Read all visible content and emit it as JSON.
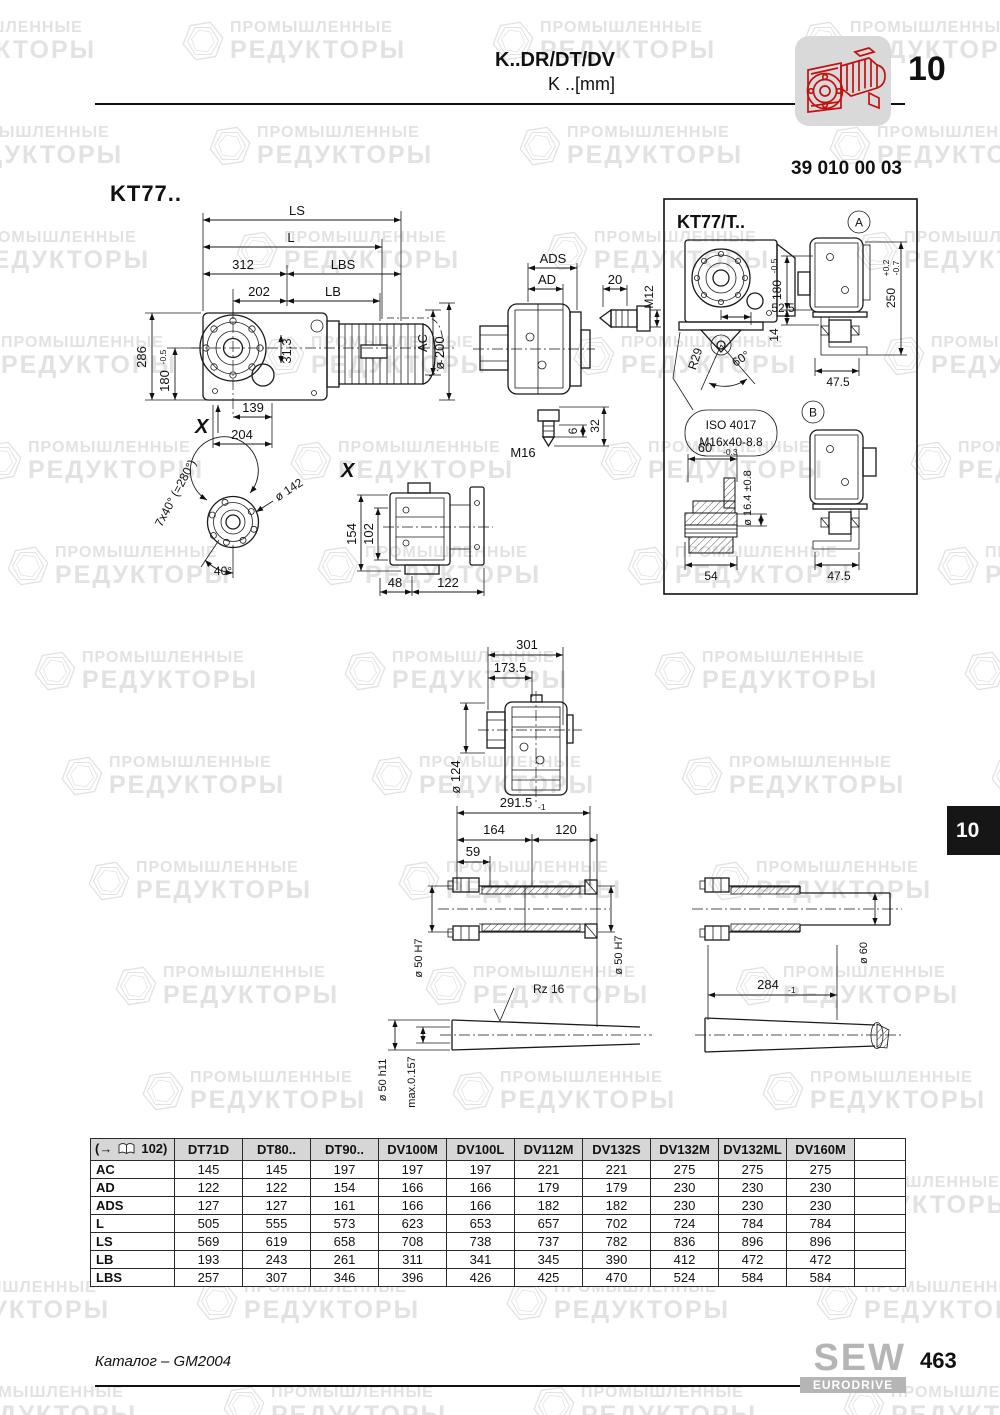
{
  "header": {
    "title_line1": "K..DR/DT/DV",
    "title_line2": "K ..[mm]",
    "chapter_number": "10",
    "drawing_number": "39 010 00 03",
    "accent_red": "#cc1111"
  },
  "watermark": {
    "line1": "ПРОМЫШЛЕННЫЕ",
    "line2": "РЕДУКТОРЫ"
  },
  "drawings": {
    "main": {
      "label": "KT77..",
      "ls": "LS",
      "l": "L",
      "n312": "312",
      "lbs": "LBS",
      "n202": "202",
      "lb": "LB",
      "n286": "286",
      "n180": "180",
      "tol180": "-0.5",
      "n313": "31.3",
      "ac": "AC",
      "dia200": "ø 200",
      "n139": "139",
      "n204": "204",
      "x": "X"
    },
    "adapter": {
      "ads": "ADS",
      "ad": "AD",
      "n20": "20",
      "m12": "M12",
      "n6": "6",
      "n32": "32",
      "m16": "M16"
    },
    "kt77t": {
      "label": "KT77/T..",
      "view_a": "A",
      "view_b": "B",
      "n525": "52.5",
      "n180": "180",
      "tol180": "-0.5",
      "n250": "250",
      "tol250u": "+0.2",
      "tol250d": "-0.7",
      "n14": "14",
      "n475a": "47.5",
      "r29": "R29",
      "a60": "60°",
      "iso1": "ISO 4017",
      "iso2": "M16x40-8.8",
      "n60": "60",
      "tol60": "-0.3",
      "dia164": "ø 16.4 ±0.8",
      "n54": "54",
      "n475b": "47.5"
    },
    "detailx": {
      "x": "X",
      "seven40": "7x40° (=280°)",
      "dia142": "ø 142",
      "a40": "40°",
      "n154": "154",
      "n102": "102",
      "n48": "48",
      "n122": "122"
    },
    "mid": {
      "n301": "301",
      "n1735": "173.5",
      "dia124": "ø 124"
    },
    "shafts": {
      "n2915": "291.5",
      "tol2915": "-1",
      "n164": "164",
      "n120": "120",
      "n59": "59",
      "dia50l": "ø 50 H7",
      "dia50r": "ø 50 H7",
      "dia60": "ø 60",
      "n284": "284",
      "tol284": "-1",
      "rz": "Rz 16",
      "dia50c": "ø 50 h11",
      "maxrun": "max.0.157"
    }
  },
  "side_tab": {
    "label": "10"
  },
  "table": {
    "ref_label": "(→",
    "ref_page": "102)",
    "columns": [
      "DT71D",
      "DT80..",
      "DT90..",
      "DV100M",
      "DV100L",
      "DV112M",
      "DV132S",
      "DV132M",
      "DV132ML",
      "DV160M"
    ],
    "rows": [
      {
        "label": "AC",
        "values": [
          "145",
          "145",
          "197",
          "197",
          "197",
          "221",
          "221",
          "275",
          "275",
          "275"
        ]
      },
      {
        "label": "AD",
        "values": [
          "122",
          "122",
          "154",
          "166",
          "166",
          "179",
          "179",
          "230",
          "230",
          "230"
        ]
      },
      {
        "label": "ADS",
        "values": [
          "127",
          "127",
          "161",
          "166",
          "166",
          "182",
          "182",
          "230",
          "230",
          "230"
        ]
      },
      {
        "label": "L",
        "values": [
          "505",
          "555",
          "573",
          "623",
          "653",
          "657",
          "702",
          "724",
          "784",
          "784"
        ]
      },
      {
        "label": "LS",
        "values": [
          "569",
          "619",
          "658",
          "708",
          "738",
          "737",
          "782",
          "836",
          "896",
          "896"
        ]
      },
      {
        "label": "LB",
        "values": [
          "193",
          "243",
          "261",
          "311",
          "341",
          "345",
          "390",
          "412",
          "472",
          "472"
        ]
      },
      {
        "label": "LBS",
        "values": [
          "257",
          "307",
          "346",
          "396",
          "426",
          "425",
          "470",
          "524",
          "584",
          "584"
        ]
      }
    ]
  },
  "footer": {
    "catalog": "Каталог – GM2004",
    "brand_line1": "SEW",
    "brand_line2": "EURODRIVE",
    "page_number": "463"
  }
}
